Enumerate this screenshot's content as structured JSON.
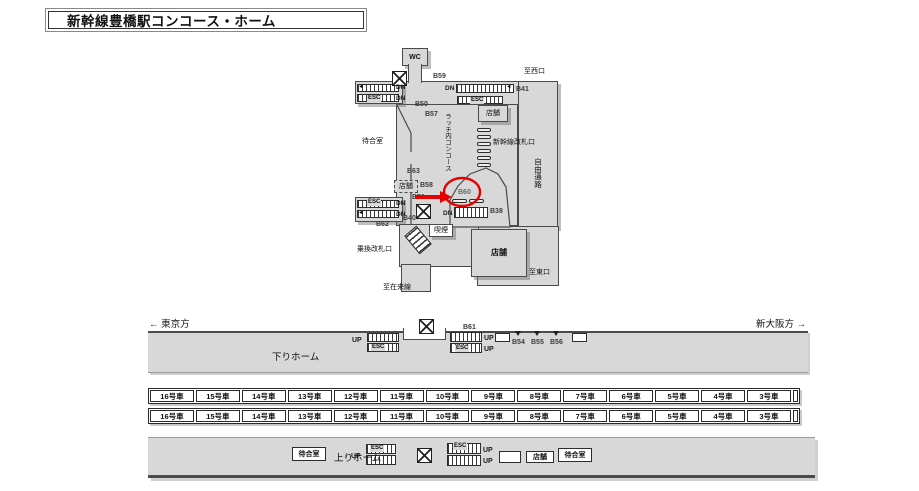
{
  "title": "新幹線豊橋駅コンコース・ホーム",
  "colors": {
    "floor": "#d8d8d8",
    "wall": "#4a4a4a",
    "annotation_red": "#e60000"
  },
  "map": {
    "wc": "WC",
    "b59": "B59",
    "to_west": "至西口",
    "dn": "DN",
    "esc": "ESC",
    "b41": "B41",
    "b50": "B50",
    "b57": "B57",
    "waiting_room": "待合室",
    "latch_concourse": "ラッチ内コンコース",
    "shop": "店舗",
    "shinkansen_gate": "新幹線改札口",
    "free_passage": "自由通路",
    "b63": "B63",
    "b58": "B58",
    "b51": "B51",
    "b60": "B60",
    "b40": "B40",
    "b62": "B62",
    "b38": "B38",
    "smoking": "喫煙",
    "transfer_gate": "乗換改札口",
    "to_east": "至東口",
    "to_local_line": "至在来線",
    "arrow_left": "◄"
  },
  "platform": {
    "to_tokyo": "← 東京方",
    "to_shin_osaka": "新大阪方 →",
    "down_platform": "下りホーム",
    "up_platform": "上りホーム",
    "b61": "B61",
    "b54": "B54",
    "b55": "B55",
    "b56": "B56",
    "up": "UP",
    "esc": "ESC",
    "waiting_room": "待合室",
    "shop": "店舗"
  },
  "cars": {
    "row1": [
      "16号車",
      "15号車",
      "14号車",
      "13号車",
      "12号車",
      "11号車",
      "10号車",
      "9号車",
      "8号車",
      "7号車",
      "6号車",
      "5号車",
      "4号車",
      "3号車"
    ],
    "row2": [
      "16号車",
      "15号車",
      "14号車",
      "13号車",
      "12号車",
      "11号車",
      "10号車",
      "9号車",
      "8号車",
      "7号車",
      "6号車",
      "5号車",
      "4号車",
      "3号車"
    ]
  }
}
